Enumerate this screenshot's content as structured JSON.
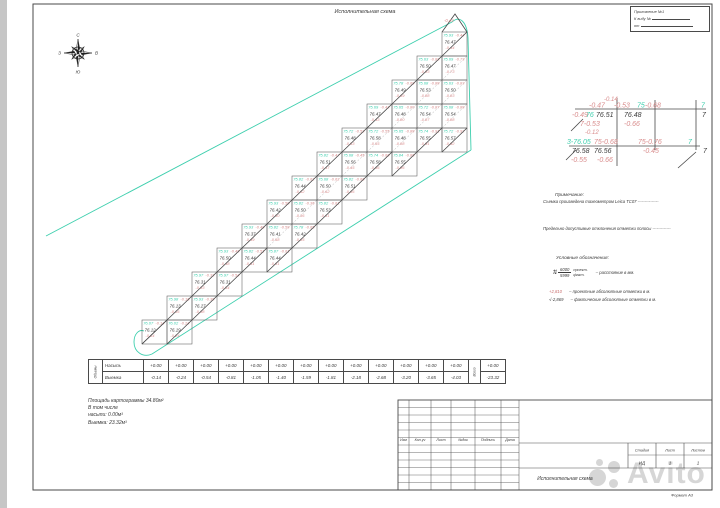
{
  "title": "Исполнительная схема",
  "corner_box": {
    "line1": "Приложение №1",
    "line2": "К виду №",
    "line3": "от"
  },
  "compass": {
    "n": "С",
    "e": "В",
    "s": "Ю",
    "w": "З"
  },
  "notes": {
    "heading": "Примечание:",
    "line1": "Съемка произведена тахеометром Leica TC07 ---------------",
    "line2": "Предельно допустимые отклонения отметки полосы -------------"
  },
  "legend": {
    "heading": "Условные обозначения:",
    "distance": {
      "top": "6000",
      "bottom": "5999",
      "top_label": "проект.",
      "bottom_label": "факт.",
      "text": "– расстояние в мм."
    },
    "marks": {
      "proj_value": "+2,810",
      "proj_text": "– проектные абсолютные отметки в м.",
      "fact_value": "-2,869",
      "fact_text": "– фактические абсолютные отметки в м.",
      "mark_symbol": "√"
    }
  },
  "volumes_table": {
    "left_label": "Объемы",
    "fill_label": "Насыпь",
    "cut_label": "Выемка",
    "fill": [
      "+0.00",
      "+0.00",
      "+0.00",
      "+0.00",
      "+0.00",
      "+0.00",
      "+0.00",
      "+0.00",
      "+0.00",
      "+0.00",
      "+0.00",
      "+0.00",
      "+0.00"
    ],
    "cut": [
      "-0.14",
      "-0.24",
      "-0.54",
      "-0.81",
      "-1.05",
      "-1.40",
      "-1.59",
      "-1.81",
      "-2.18",
      "-2.68",
      "-3.20",
      "-3.65",
      "-4.03"
    ],
    "total_label": "Всего",
    "fill_total": "+0.00",
    "cut_total": "-23.32"
  },
  "summary": {
    "line1": "Площадь картограммы  34.80м²",
    "line2": "В том числе",
    "line3": "насыпи:  0.00м³",
    "line4": "Выемка:  23.32м³"
  },
  "title_block": {
    "header_cols": [
      "Изм",
      "Кол.уч",
      "Лист",
      "№док",
      "Подпись",
      "Дата"
    ],
    "stage_label": "Стадия",
    "sheet_label": "Лист",
    "sheets_label": "Листов",
    "stage": "ИД",
    "sheet": "1",
    "sheets": "1",
    "doc_title": "Исполнительная схема"
  },
  "format_label": "Формат А3",
  "watermark": "Avito",
  "colors": {
    "teal": "#3ecfae",
    "red": "#d98d8d",
    "ink": "#3a3a3a"
  },
  "grid": {
    "roof_value": "-0.44",
    "columns": [
      {
        "cells": [
          [
            76.07,
            76.12,
            -0.14
          ]
        ]
      },
      {
        "cells": [
          [
            75.98,
            76.13,
            -0.16
          ],
          [
            76.02,
            76.19,
            -0.24
          ]
        ]
      },
      {
        "cells": [
          [
            75.97,
            76.31,
            -0.33
          ],
          [
            75.93,
            76.27,
            -0.38
          ]
        ]
      },
      {
        "cells": [
          [
            75.93,
            76.5,
            -0.48
          ],
          [
            75.97,
            76.31,
            -0.54
          ]
        ]
      },
      {
        "cells": [
          [
            75.93,
            76.37,
            -0.49
          ],
          [
            75.82,
            76.44,
            -0.51
          ]
        ]
      },
      {
        "cells": [
          [
            75.93,
            76.42,
            -0.5
          ],
          [
            75.82,
            76.41,
            -0.58
          ],
          [
            75.87,
            76.44,
            -0.61
          ]
        ]
      },
      {
        "cells": [
          [
            75.82,
            76.44,
            -0.62
          ],
          [
            75.82,
            76.5,
            -0.36
          ],
          [
            75.78,
            76.42,
            -0.65
          ]
        ]
      },
      {
        "cells": [
          [
            75.82,
            76.51,
            -0.47
          ],
          [
            75.68,
            76.5,
            -0.62
          ],
          [
            75.82,
            76.53,
            -0.61
          ]
        ]
      },
      {
        "cells": [
          [
            75.72,
            76.48,
            -0.53
          ],
          [
            75.68,
            76.56,
            -0.45
          ],
          [
            75.82,
            76.51,
            -0.66
          ]
        ]
      },
      {
        "cells": [
          [
            75.69,
            76.47,
            -0.43
          ],
          [
            75.72,
            76.58,
            -0.55
          ],
          [
            75.74,
            76.58,
            -0.66
          ]
        ]
      },
      {
        "cells": [
          [
            75.78,
            76.49,
            -0.69
          ],
          [
            75.65,
            76.48,
            -0.8
          ],
          [
            75.65,
            76.48,
            -0.88
          ],
          [
            75.84,
            76.55,
            -0.86
          ]
        ]
      },
      {
        "cells": [
          [
            75.63,
            76.5,
            -0.83
          ],
          [
            75.68,
            76.53,
            -0.88
          ],
          [
            75.72,
            76.54,
            -0.87
          ],
          [
            75.74,
            76.55,
            -0.91
          ]
        ]
      },
      {
        "cells": [
          [
            75.93,
            76.47,
            -0.44
          ],
          [
            75.69,
            76.47,
            -0.73
          ],
          [
            75.63,
            76.5,
            -0.83
          ],
          [
            75.68,
            76.54,
            -0.88
          ],
          [
            75.72,
            76.57,
            -0.92
          ]
        ]
      }
    ]
  },
  "inset": {
    "lines": [
      [
        575,
        109,
        706,
        109
      ],
      [
        569,
        146,
        700,
        146
      ],
      [
        617,
        98,
        617,
        166
      ],
      [
        655,
        100,
        655,
        150
      ],
      [
        696,
        100,
        696,
        150
      ],
      [
        678,
        168,
        696,
        152
      ],
      [
        571,
        131,
        583,
        119
      ],
      [
        566,
        160,
        576,
        150
      ]
    ],
    "texts": [
      [
        604,
        101,
        "-0.14",
        "red",
        6
      ],
      [
        589,
        107.5,
        "-0.47",
        "red",
        7
      ],
      [
        614,
        107.5,
        "-0.53",
        "red",
        7
      ],
      [
        637,
        107.5,
        "75",
        "teal",
        7
      ],
      [
        645,
        107.5,
        "-0.68",
        "red",
        7
      ],
      [
        701,
        107.5,
        "7",
        "teal",
        7
      ],
      [
        572,
        117,
        "-0.49",
        "red",
        7
      ],
      [
        586,
        117,
        "76",
        "teal",
        7
      ],
      [
        596,
        117,
        "76.51",
        "ink",
        7
      ],
      [
        624,
        117,
        "76.48",
        "ink",
        7
      ],
      [
        702,
        117,
        "7",
        "ink",
        7
      ],
      [
        580,
        126,
        "7-0.53",
        "red",
        7
      ],
      [
        624,
        126,
        "-0.66",
        "red",
        7
      ],
      [
        585,
        134,
        "-0.12",
        "red",
        6
      ],
      [
        567,
        144,
        "3-76.05",
        "teal",
        7
      ],
      [
        594,
        144,
        "75-0.68",
        "red",
        7
      ],
      [
        638,
        144,
        "75-0.76",
        "red",
        7
      ],
      [
        688,
        144,
        "7",
        "teal",
        7
      ],
      [
        572,
        153,
        "76.58",
        "ink",
        7
      ],
      [
        594,
        153,
        "76.56",
        "ink",
        7
      ],
      [
        643,
        153,
        "-0.45",
        "red",
        7
      ],
      [
        703,
        153,
        "7",
        "ink",
        7
      ],
      [
        571,
        162,
        "-0.55",
        "red",
        7
      ],
      [
        597,
        162,
        "-0.66",
        "red",
        7
      ]
    ]
  }
}
